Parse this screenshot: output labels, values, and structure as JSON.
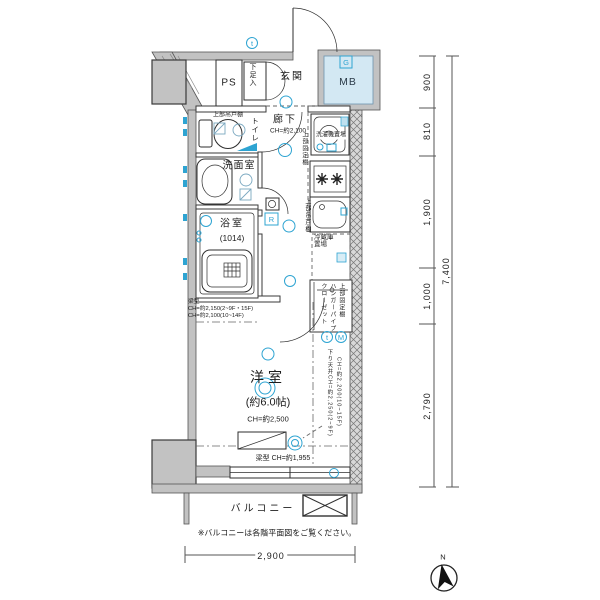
{
  "plan": {
    "rooms": {
      "ps": "PS",
      "genkan": "玄関",
      "mb": "MB",
      "toilet": "トイレ",
      "hallway": "廊下",
      "hallway_ch": "CH=約2,100",
      "washroom": "洗面室",
      "bathroom": "浴室",
      "bathroom_size": "(1014)",
      "western": "洋室",
      "western_size": "(約6.0帖)",
      "western_ch": "CH=約2,500",
      "balcony": "バルコニー"
    },
    "storage": {
      "shoe_box": "下足入",
      "toilet_shelf": "上部吊戸棚",
      "washer": "洗濯機置場",
      "washer_shelf": "上部固定棚",
      "kitchen_shelf": "上部吊戸棚",
      "fridge_l1": "冷蔵庫",
      "fridge_l2": "置場",
      "closet_shelf": "上部固定棚",
      "closet_pipe": "ハンガーパイプ",
      "closet": "クローゼット"
    },
    "annotations": {
      "beam_title": "梁型",
      "beam_line1": "CH=約2,150(2~9F・15F)",
      "beam_line2": "CH=約2,100(10~14F)",
      "down_ceiling_1": "下り天井CH=約2,250(2~9F)",
      "down_ceiling_2": "CH=約2,200(10~15F)",
      "beam_lower": "梁型 CH=約1,955",
      "balcony_note": "※バルコニーは各階平面図をご覧ください。"
    },
    "dimensions": {
      "right": [
        "900",
        "810",
        "1,900",
        "1,000",
        "2,790"
      ],
      "right_total": "7,400",
      "bottom": "2,900"
    },
    "symbols": {
      "t1": "t",
      "gas": "G",
      "remote": "R",
      "t2": "t",
      "meter": "M",
      "north": "N"
    },
    "colors": {
      "wall": "#c2c2c2",
      "outline": "#333333",
      "accent": "#2ea4d2",
      "mb_fill": "#d3e8f3"
    }
  }
}
